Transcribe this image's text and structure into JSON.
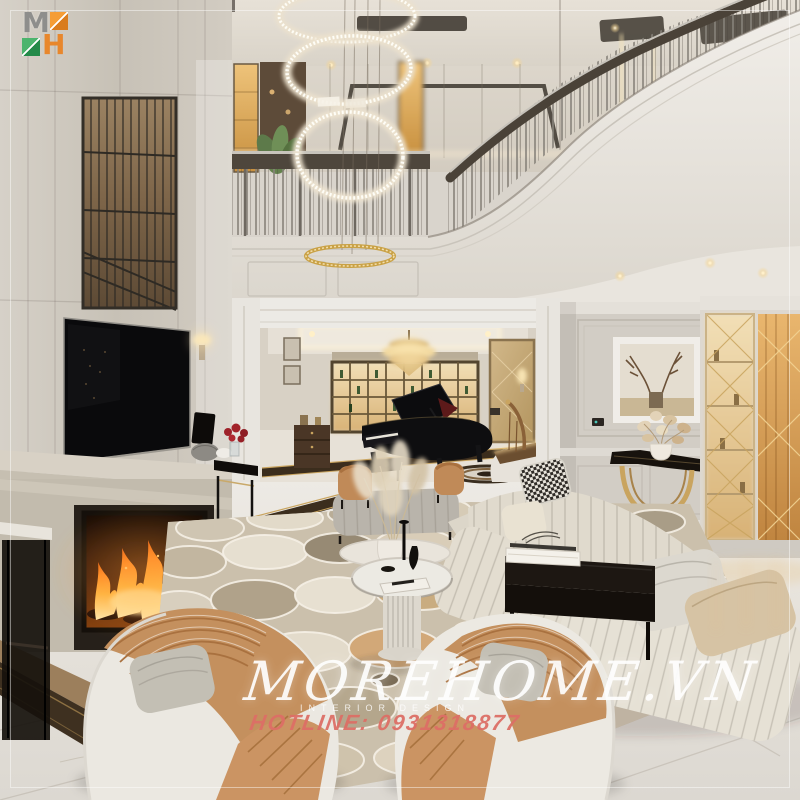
{
  "scene": {
    "description": "Luxury two-storey neoclassical living room: mezzanine with metal railing and curved white balcony, crystal ring chandeliers, marble TV wall with fireplace, grand piano and wine cabinet in back room, deer artwork over gold console, lit display cabinet, cream sectional sofa, patterned rug and two tan-and-white armchairs"
  },
  "logo": {
    "letter_m": "M",
    "letter_h": "H",
    "orange": "#e8872c",
    "green": "#2c8f4e",
    "gray": "#8e8e8c"
  },
  "watermark": {
    "brand": "MOREHOME.VN",
    "subtitle": "INTERIOR DESIGN",
    "hotline": "HOTLINE: 0931318877",
    "brand_color": "#ffffff",
    "hotline_color": "#dd6f66"
  },
  "palette": {
    "wall_greige": "#d5d0c8",
    "white_trim": "#eceae5",
    "marble_floor": "#e7e3dd",
    "gold_accent": "#c9a45f",
    "flame_orange": "#ff9e2e",
    "piano_black": "#0e0e10",
    "sofa_cream": "#e3ddd0",
    "leather_tan": "#c4905e",
    "rug_tan": "#c8b49a",
    "hearth_dark": "#3e3020"
  }
}
